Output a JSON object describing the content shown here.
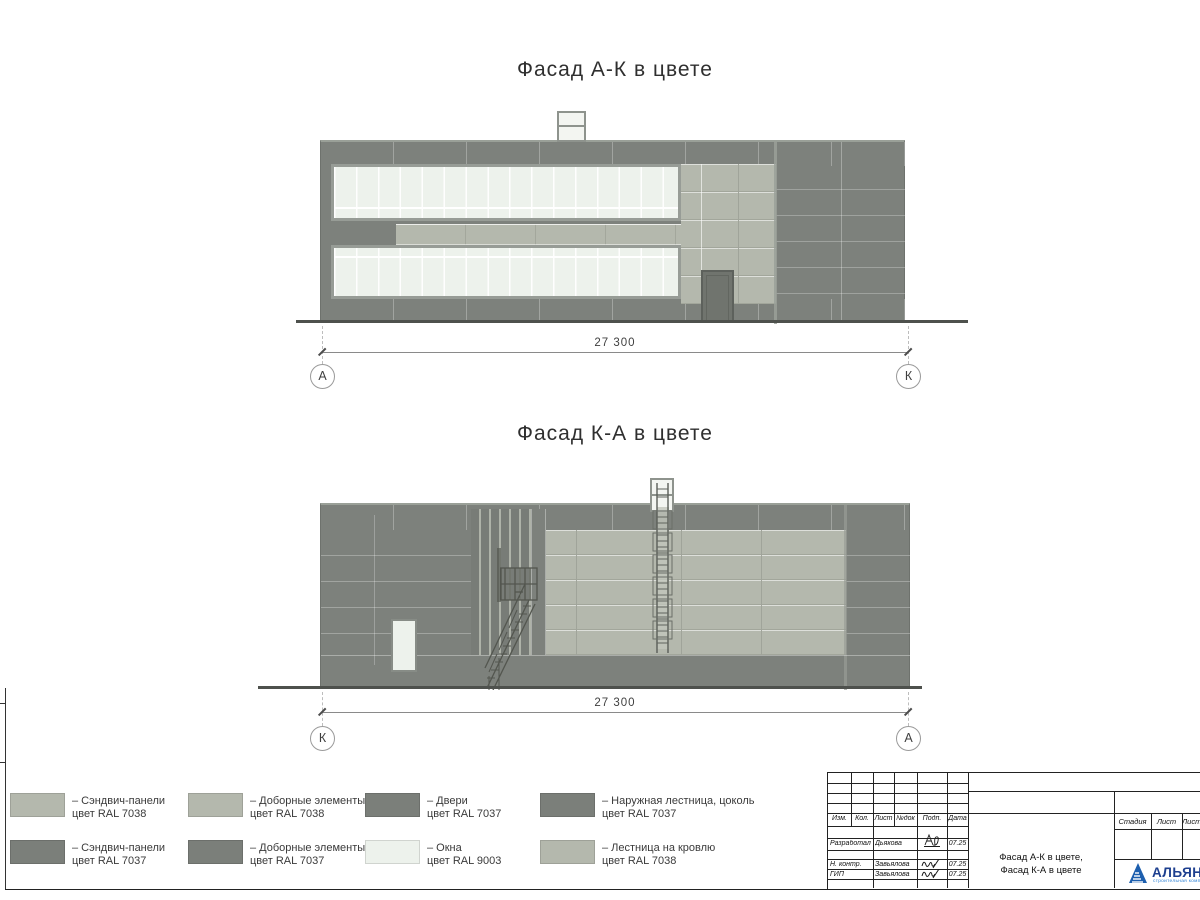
{
  "facade1": {
    "title": "Фасад А-К в цвете",
    "dimension": "27 300",
    "axis_left": "А",
    "axis_right": "К"
  },
  "facade2": {
    "title": "Фасад К-А в цвете",
    "dimension": "27 300",
    "axis_left": "К",
    "axis_right": "А"
  },
  "colors": {
    "wall_dark": "#7b7f7a",
    "panel_light": "#b4b8ad",
    "window_white": "#edf2ec"
  },
  "legend": {
    "items": [
      {
        "line1": "– Сэндвич-панели",
        "line2": "цвет RAL 7038",
        "color": "#b4b8ad"
      },
      {
        "line1": "– Сэндвич-панели",
        "line2": "цвет RAL 7037",
        "color": "#7b7f7a"
      },
      {
        "line1": "– Доборные элементы",
        "line2": "цвет RAL 7038",
        "color": "#b4b8ad"
      },
      {
        "line1": "– Доборные элементы",
        "line2": "цвет RAL 7037",
        "color": "#7b7f7a"
      },
      {
        "line1": "– Двери",
        "line2": "цвет RAL 7037",
        "color": "#7b7f7a"
      },
      {
        "line1": "– Окна",
        "line2": "цвет RAL 9003",
        "color": "#edf2ec"
      },
      {
        "line1": "– Наружная лестница, цоколь",
        "line2": "цвет RAL 7037",
        "color": "#7b7f7a"
      },
      {
        "line1": "– Лестница на кровлю",
        "line2": "цвет RAL 7038",
        "color": "#b4b8ad"
      }
    ]
  },
  "stamp": {
    "revision_header": [
      "Изм.",
      "Кол.",
      "Лист",
      "№док",
      "Подп.",
      "Дата"
    ],
    "signature_rows": [
      {
        "role": "Разработал",
        "name": "Дьякова",
        "date": "07.25"
      },
      {
        "role": "Н. контр.",
        "name": "Завьялова",
        "date": "07.25"
      },
      {
        "role": "ГИП",
        "name": "Завьялова",
        "date": "07.25"
      }
    ],
    "doc_title_line1": "Фасад А-К в цвете,",
    "doc_title_line2": "Фасад К-А в цвете",
    "stage_header": [
      "Стадия",
      "Лист",
      "Листов"
    ],
    "logo_text": "АЛЬЯНС",
    "logo_subtext": "строительная компания"
  }
}
